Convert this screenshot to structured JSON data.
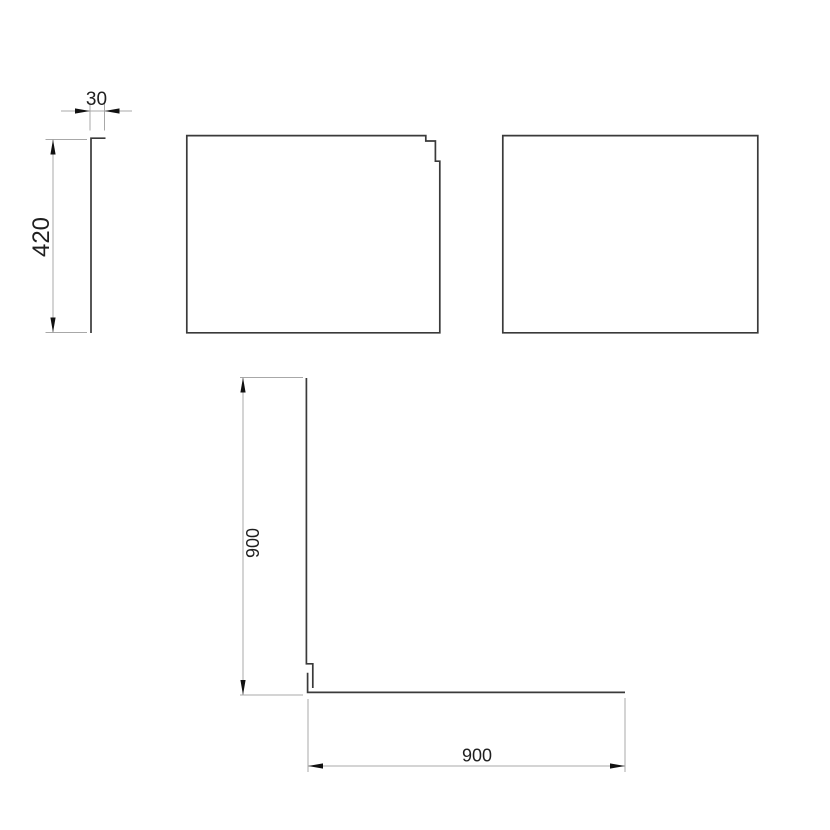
{
  "drawing": {
    "type": "technical-drawing-multiview",
    "colors": {
      "background": "#ffffff",
      "part_line": "#3a3a3a",
      "dimension_line": "#a8a8a8",
      "arrow": "#111111",
      "text": "#1f1f1f"
    },
    "dimensions": {
      "thickness": "30",
      "panel_height": "420",
      "upright_length": "900",
      "base_length": "900"
    }
  }
}
